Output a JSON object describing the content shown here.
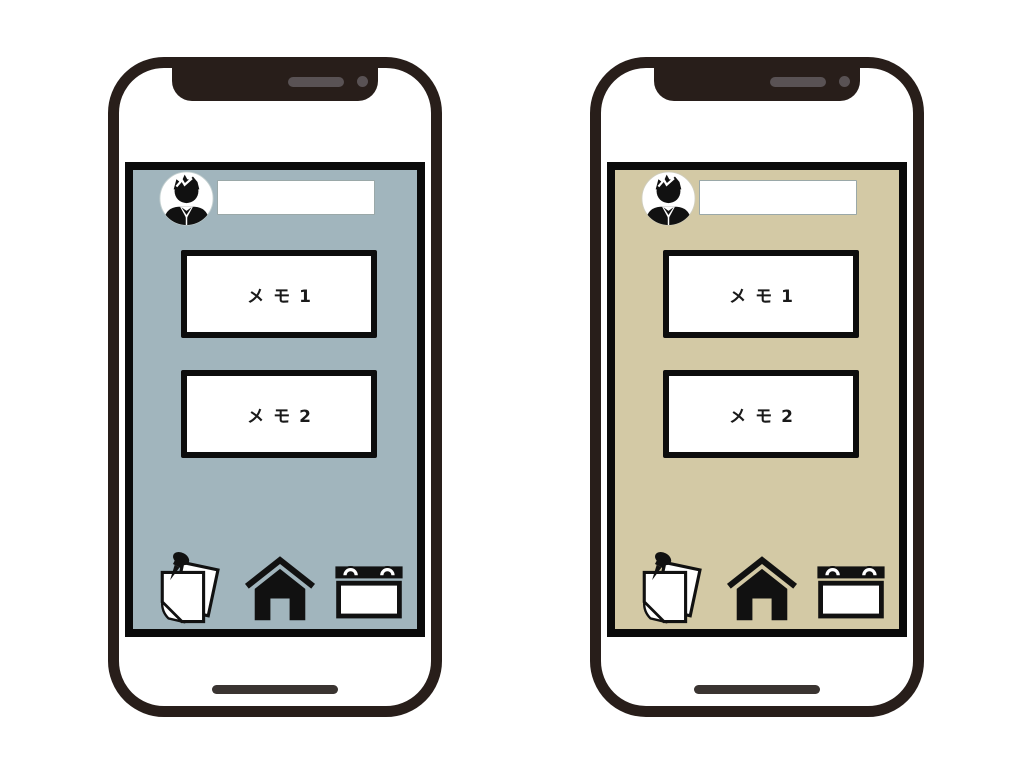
{
  "page": {
    "background": "#ffffff",
    "description": "two-smartphone memo app mockup"
  },
  "colors": {
    "frame": "#281e1a",
    "screen_border": "#0a0a0a",
    "speaker": "#595254",
    "home_bar": "#3a3431",
    "left_screen": "#a1b5bd",
    "right_screen": "#d3c9a5"
  },
  "phones": [
    {
      "name": "left-phone",
      "screen_color": "#a1b5bd",
      "profile": {
        "avatar_icon": "person-avatar-icon",
        "input_value": "",
        "input_placeholder": ""
      },
      "memos": [
        {
          "label": "メモ1"
        },
        {
          "label": "メモ2"
        }
      ],
      "nav": {
        "items": [
          {
            "icon": "memo-notes-icon"
          },
          {
            "icon": "home-icon"
          },
          {
            "icon": "calendar-icon"
          }
        ]
      }
    },
    {
      "name": "right-phone",
      "screen_color": "#d3c9a5",
      "profile": {
        "avatar_icon": "person-avatar-icon",
        "input_value": "",
        "input_placeholder": ""
      },
      "memos": [
        {
          "label": "メモ1"
        },
        {
          "label": "メモ2"
        }
      ],
      "nav": {
        "items": [
          {
            "icon": "memo-notes-icon"
          },
          {
            "icon": "home-icon"
          },
          {
            "icon": "calendar-icon"
          }
        ]
      }
    }
  ]
}
